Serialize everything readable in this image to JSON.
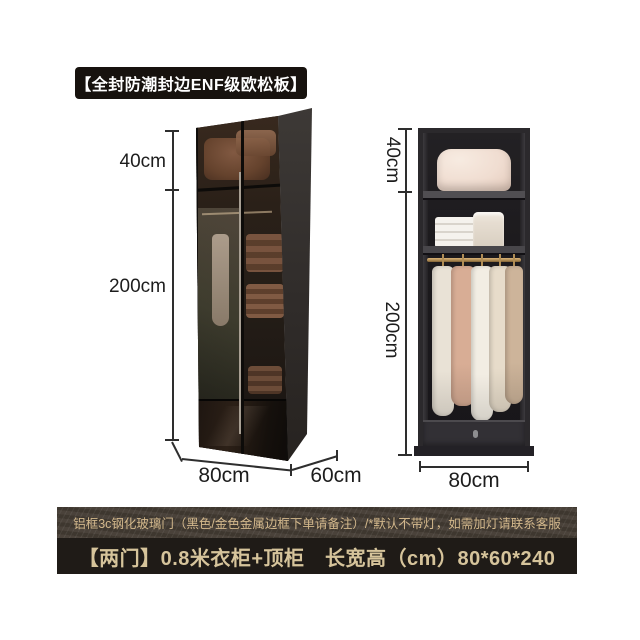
{
  "badge": {
    "label": "【全封防潮封边ENF级欧松板】"
  },
  "left_wardrobe": {
    "view": "closed glass-door perspective view",
    "top_cabinet_height": "40cm",
    "body_height": "200cm",
    "width": "80cm",
    "depth": "60cm"
  },
  "right_wardrobe": {
    "view": "open front view with shelves, hanging rod and drawer",
    "top_cabinet_height": "40cm",
    "body_height": "200cm",
    "width": "80cm"
  },
  "footer": {
    "note": "铝框3c钢化玻璃门（黑色/金色金属边框下单请备注）/*默认不带灯，如需加灯请联系客服",
    "title": "【两门】0.8米衣柜+顶柜　长宽高（cm）80*60*240"
  },
  "colors": {
    "background": "#ffffff",
    "badge_bg": "#17120e",
    "badge_text": "#ffffff",
    "dimension_text": "#1d1d1d",
    "note_banner_bg": "#443c34",
    "note_text": "#d3b88c",
    "title_banner_bg": "#1f1b17",
    "title_text": "#d6c49b",
    "wardrobe_body": "#2b292c",
    "hanging_rod_gold": "#b08d55"
  },
  "garments": [
    {
      "x": 14,
      "w": 22,
      "h": 150,
      "color": "#e9e2d6"
    },
    {
      "x": 33,
      "w": 24,
      "h": 140,
      "color": "#d8ad95"
    },
    {
      "x": 53,
      "w": 22,
      "h": 155,
      "color": "#f2ede3"
    },
    {
      "x": 71,
      "w": 22,
      "h": 146,
      "color": "#e7dcca"
    },
    {
      "x": 87,
      "w": 18,
      "h": 138,
      "color": "#cdb49a"
    }
  ]
}
